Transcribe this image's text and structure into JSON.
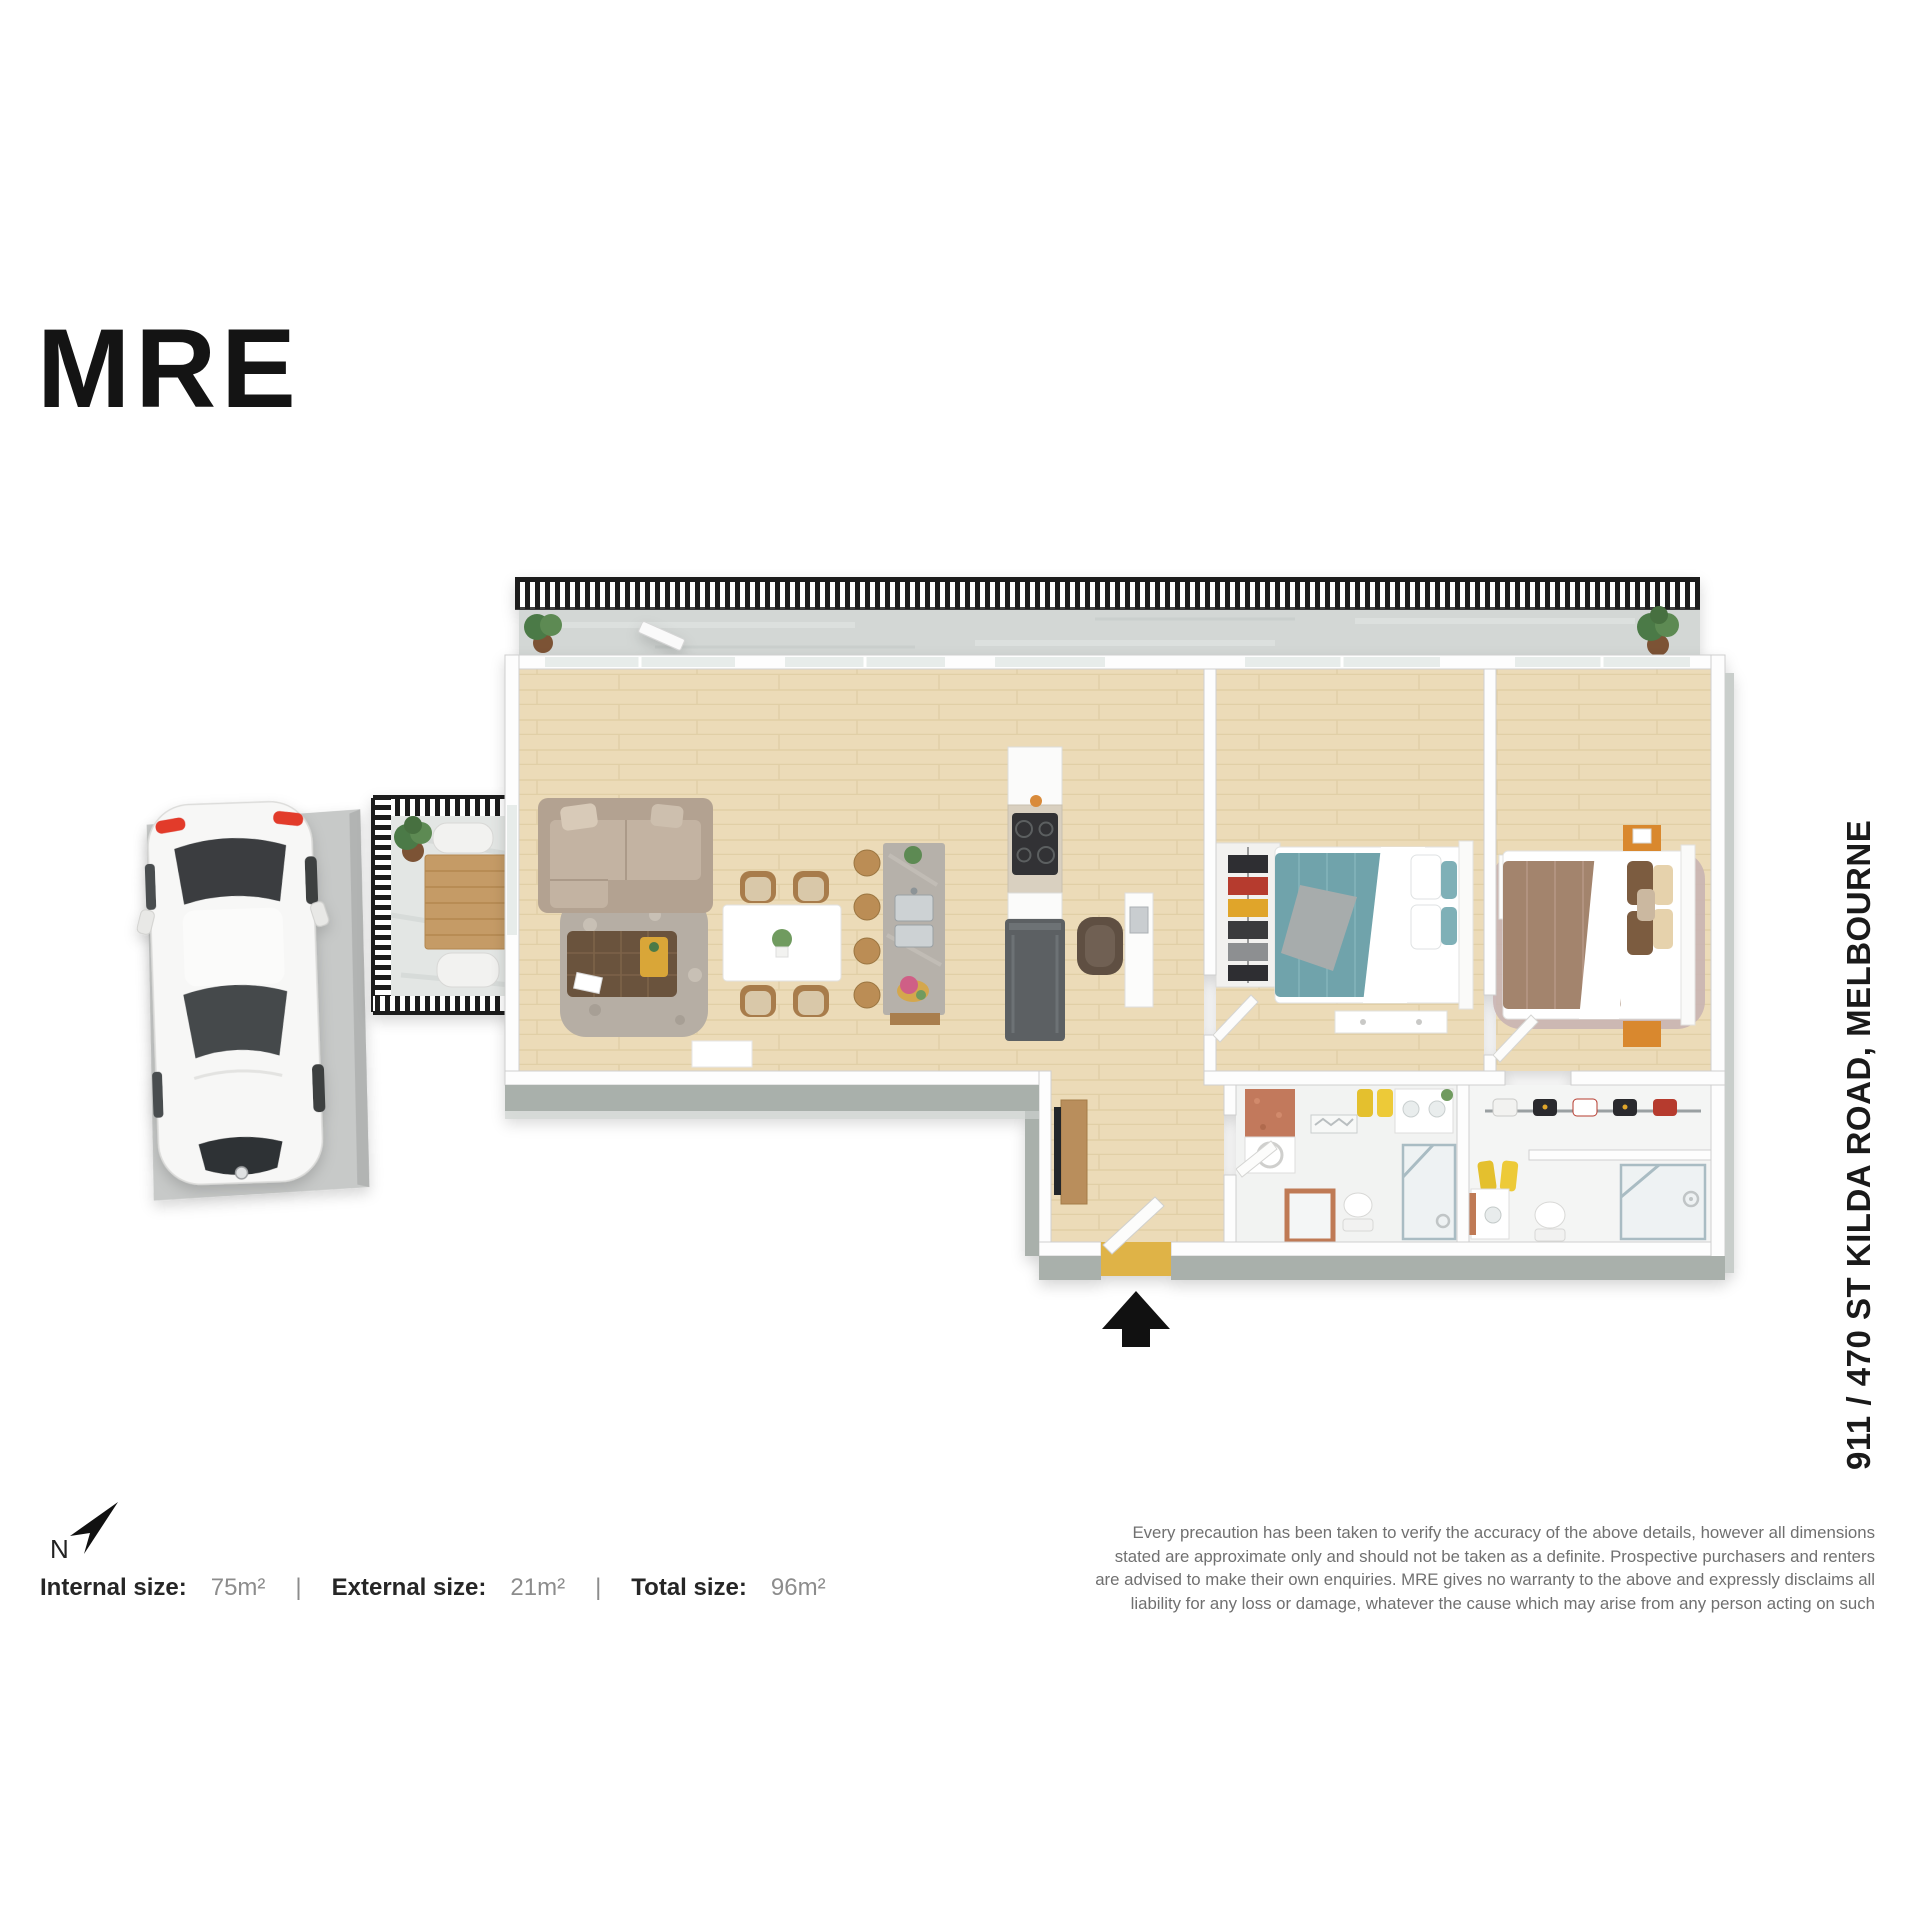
{
  "brand": {
    "logo_text": "MRE"
  },
  "property": {
    "address": "911 / 470 ST KILDA ROAD, MELBOURNE",
    "compass_label": "N"
  },
  "sizes": {
    "internal_label": "Internal size:",
    "internal_value": "75m²",
    "external_label": "External size:",
    "external_value": "21m²",
    "total_label": "Total size:",
    "total_value": "96m²",
    "separator": "|"
  },
  "disclaimer": "Every precaution has been taken to verify the accuracy of the above details, however all dimensions stated are approximate only and should not be taken as a definite. Prospective purchasers and renters are advised to make their own enquiries. MRE gives no warranty to the above and expressly disclaims all liability for any loss or damage, whatever the cause which may arise from any person acting on such",
  "floor_plan": {
    "type": "3d-apartment-floor-plan",
    "features": [
      "car-space",
      "balcony-small",
      "balcony-main",
      "living-dining",
      "kitchen-island",
      "study-nook",
      "entry",
      "bedroom-1",
      "bedroom-2",
      "walk-in-robe",
      "bathroom",
      "ensuite",
      "laundry"
    ],
    "colors": {
      "railing": "#1d1d1d",
      "wood_floor": "#ecdbb8",
      "balcony_concrete": "#d3d7d5",
      "wall_top_face": "#a9b0ab",
      "bed1_teal": "#6fa3ab",
      "bed2_brown": "#a3846d",
      "entry_mat_gold": "#dfb347"
    }
  }
}
